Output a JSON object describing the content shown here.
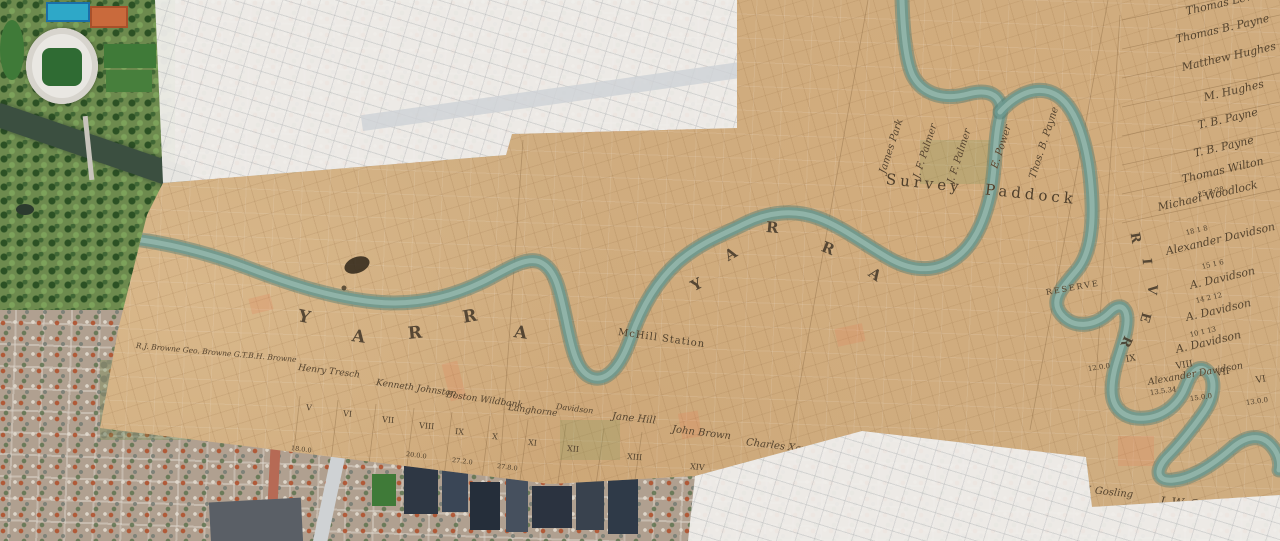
{
  "historical_map": {
    "region_labels": {
      "survey_paddock": "Survey  Paddock",
      "reserve": "RESERVE",
      "station": "McHill Station"
    },
    "river_word_1": [
      "Y",
      "A",
      "R",
      "R",
      "A"
    ],
    "river_word_2": [
      "Y",
      "A",
      "R",
      "R",
      "A"
    ],
    "river_word_3": [
      "R",
      "I",
      "V",
      "E",
      "R"
    ],
    "owners_east": [
      "Thomas Lewis",
      "Thomas B. Payne",
      "Matthew Hughes",
      "M. Hughes",
      "T. B. Payne",
      "T. B. Payne",
      "Thomas Wilton",
      "Michael Woodlock",
      "Alexander Davidson",
      "A. Davidson",
      "A. Davidson",
      "A. Davidson",
      "Alexander Davidson"
    ],
    "owners_north": [
      "James Park",
      "J. F. Palmer",
      "J. F. Palmer",
      "E. Power",
      "Thos. B. Payne"
    ],
    "owners_south": [
      "R.J. Browne  Geo. Browne  G.T.B.H. Browne",
      "Henry Tresch",
      "Kenneth Johnston",
      "Boston Wildbank",
      "Langhorne",
      "Davidson",
      "Jane Hill",
      "John Brown",
      "Charles Xavier",
      "& N. J. Browne",
      "J. B. Campbell",
      "W. H. Yaldwyn",
      "W. Gosling",
      "J. W. Gosling"
    ],
    "allotment_numerals_south": [
      "V",
      "VI",
      "VII",
      "VIII",
      "IX",
      "X",
      "XI",
      "XII",
      "XIII",
      "XIV"
    ],
    "allotment_numerals_east": [
      "IX",
      "VIII",
      "VII",
      "VI"
    ],
    "areas_east": [
      "12.0.0",
      "13.5.34",
      "15.0.0",
      "13.0.0"
    ],
    "areas_south": [
      "18.0.0",
      "20.0.0",
      "27.2.0",
      "27.8.0"
    ],
    "lot_numbers_east": [
      "25 3 28",
      "18 1 8",
      "15 1 6",
      "14 2 12",
      "10 1 13"
    ]
  },
  "colors": {
    "map_paper": "#cfad80",
    "historic_river": "#6f9a90",
    "ink": "#4e3e2a",
    "blank_sheet": "#f3f2ef",
    "satellite_park": "#6d8a4e",
    "satellite_river": "#3b4f40",
    "stadium_roof": "#e9e7e2"
  }
}
